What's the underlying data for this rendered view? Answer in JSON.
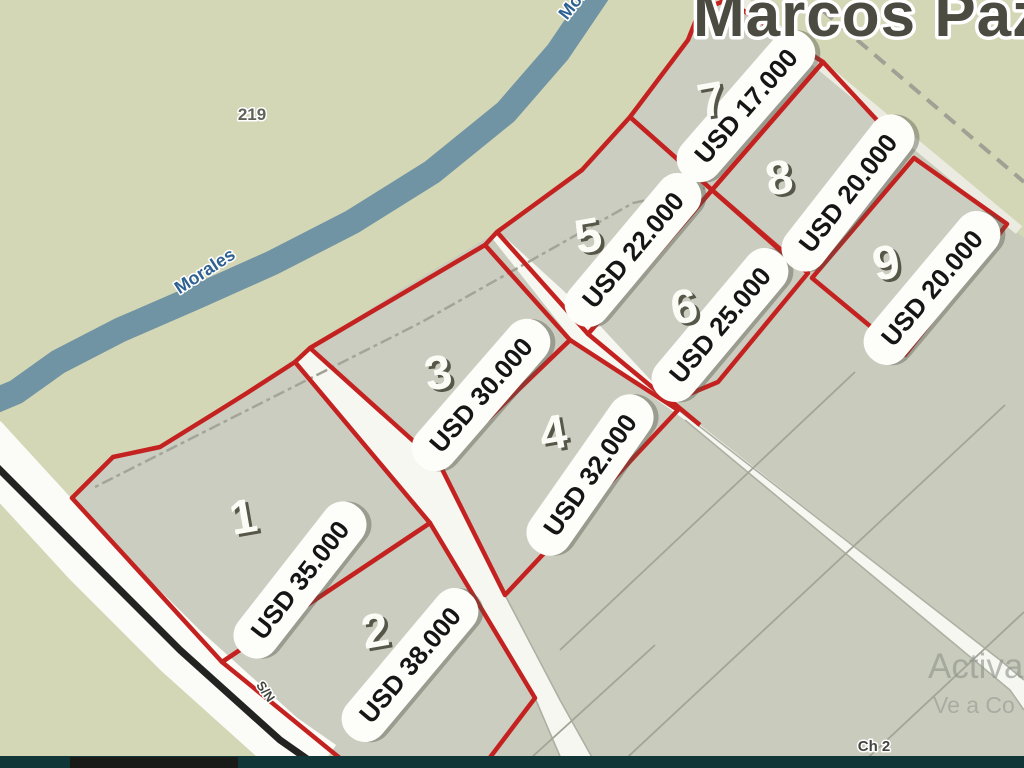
{
  "title": {
    "text": "Marcos Paz"
  },
  "watermark": {
    "line1": "Activa",
    "line2": "Ve a Co"
  },
  "labels": [
    {
      "name": "label-route-219",
      "text": "219",
      "x": 252,
      "y": 120,
      "size": 17,
      "fill": "gray_label",
      "rot": 0,
      "halo": 3
    },
    {
      "name": "label-river-morales",
      "text": "Morales",
      "x": 208,
      "y": 276,
      "size": 18,
      "fill": "water_label",
      "rot": -33,
      "halo": 3
    },
    {
      "name": "label-river-morales-top",
      "text": "Morales",
      "x": 588,
      "y": -6,
      "size": 18,
      "fill": "water_label",
      "rot": -52,
      "halo": 3
    },
    {
      "name": "label-road-sn",
      "text": "S/N",
      "x": 262,
      "y": 694,
      "size": 13,
      "fill": "dark_label",
      "rot": 55,
      "halo": 3
    },
    {
      "name": "label-ch2",
      "text": "Ch 2",
      "x": 874,
      "y": 751,
      "size": 15,
      "fill": "dark_label",
      "rot": 0,
      "halo": 3
    }
  ],
  "parcels": [
    {
      "number": "1",
      "price": "USD 35.000",
      "points": "72,498 113,457 160,447 215,413 247,393 295,362 430,523 222,662",
      "num_x": 243,
      "num_y": 516,
      "pill_x": 300,
      "pill_y": 580,
      "pill_rot": -52
    },
    {
      "number": "2",
      "price": "USD 38.000",
      "points": "222,662 430,523 535,698 482,768 352,768",
      "num_x": 375,
      "num_y": 630,
      "pill_x": 410,
      "pill_y": 665,
      "pill_rot": -50
    },
    {
      "number": "3",
      "price": "USD 30.000",
      "points": "310,348 485,245 570,340 440,465",
      "num_x": 438,
      "num_y": 372,
      "pill_x": 481,
      "pill_y": 395,
      "pill_rot": -49
    },
    {
      "number": "4",
      "price": "USD 32.000",
      "points": "440,465 570,340 678,410 505,595",
      "num_x": 553,
      "num_y": 432,
      "pill_x": 590,
      "pill_y": 475,
      "pill_rot": -55
    },
    {
      "number": "5",
      "price": "USD 22.000",
      "points": "497,232 582,170 630,117 712,190 588,334",
      "num_x": 588,
      "num_y": 235,
      "pill_x": 633,
      "pill_y": 250,
      "pill_rot": -50
    },
    {
      "number": "6",
      "price": "USD 25.000",
      "points": "588,334 712,190 808,273 718,382 670,402",
      "num_x": 684,
      "num_y": 306,
      "pill_x": 720,
      "pill_y": 325,
      "pill_rot": -50
    },
    {
      "number": "7",
      "price": "USD 17.000",
      "points": "630,117 688,40 700,10 727,0 823,62 712,190",
      "num_x": 711,
      "num_y": 99,
      "pill_x": 746,
      "pill_y": 106,
      "pill_rot": -49
    },
    {
      "number": "8",
      "price": "USD 20.000",
      "points": "823,62 900,145 800,268 712,190",
      "num_x": 779,
      "num_y": 177,
      "pill_x": 848,
      "pill_y": 193,
      "pill_rot": -52
    },
    {
      "number": "9",
      "price": "USD 20.000",
      "points": "914,158 1007,224 905,355 812,278",
      "num_x": 886,
      "num_y": 262,
      "pill_x": 932,
      "pill_y": 288,
      "pill_rot": -50
    }
  ],
  "geometry": {
    "farmland": "72,498 113,457 160,447 215,413 247,393 310,348 400,290 497,232 582,170 630,117 686,44 710,8 727,0 823,62 917,143 1007,224 1024,238 1024,768 352,768 222,662",
    "streets": [
      "310,348 440,465 505,595 560,700 598,768 565,768 535,698 430,523 295,362",
      "497,230 590,315 672,403 1000,660 1024,680 1024,710 1010,690 685,420 570,337 492,238"
    ],
    "street_edges": [
      "505,595 560,700 598,768",
      "535,698 565,768",
      "672,405 1000,660 1024,680",
      "685,420 1010,690 1024,710"
    ],
    "road_white": "-20,440 0,462 90,560 180,650 280,740 320,768",
    "road_black": "-15,455 90,560 180,650 280,740 320,768",
    "river": "600,-10 558,52 506,112 432,172 352,222 272,263 196,297 120,330 58,362 16,392 -8,402",
    "thin_lines": [
      "855,372 560,650",
      "1005,405 616,768",
      "1024,612 857,768",
      "655,645 520,768"
    ],
    "dashed_lines": [
      {
        "pts": "95,487 420,323 633,203 705,188",
        "w": 2.5,
        "dash": "4 4 12 4"
      },
      {
        "pts": "822,10 1024,182",
        "w": 4,
        "dash": "14 9"
      }
    ],
    "pale_lines": [
      {
        "pts": "737,-4 1019,230",
        "w": 10
      }
    ],
    "joints": [
      "295,362 310,348",
      "485,245 497,232",
      "665,396 700,425"
    ],
    "bars": [
      {
        "x": 0,
        "y": 756,
        "w": 1024,
        "h": 12,
        "fill": "dark_bar"
      },
      {
        "x": 70,
        "y": 757,
        "w": 168,
        "h": 11,
        "fill": "bar_black"
      }
    ],
    "pill_w": 186,
    "pill_h": 46,
    "pill_rx": 22
  },
  "colors": {
    "bg": "#d4d7b6",
    "farmland": "#c9cbbd",
    "street": "#f7f7f2",
    "street_edge": "#aeb0a4",
    "road_white": "#fbfbf8",
    "road_black": "#232321",
    "river": "#7094a3",
    "thin": "#a3a598",
    "dashed": "#9fa194",
    "pale": "#ebebe1",
    "red": "#c42220",
    "pill_bg": "#fdfdfa",
    "pill_text": "#151515",
    "pill_shadow": "rgba(80,82,70,0.4)",
    "number": "#fcfcf6",
    "number_shadow": "#565749",
    "title": "#4b4b41",
    "halo": "#ffffff",
    "water_label": "#2e6191",
    "gray_label": "#60635a",
    "dark_label": "#42453e",
    "watermark": "#8f948b",
    "dark_bar": "#113638",
    "bar_black": "#181b18"
  }
}
